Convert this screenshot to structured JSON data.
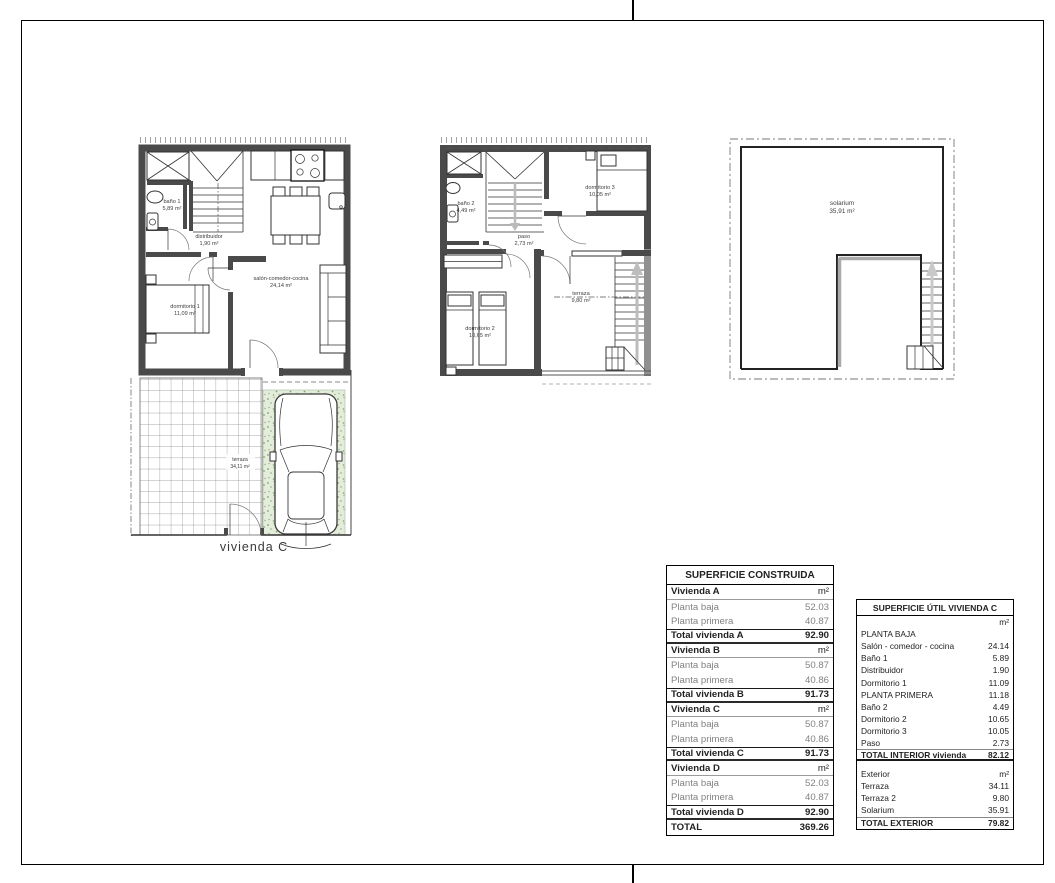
{
  "caption": {
    "vivienda": "vivienda C"
  },
  "plans": {
    "planta_baja": {
      "bano1_name": "baño 1",
      "bano1_area": "5,89 m²",
      "distribuidor_name": "distribuidor",
      "distribuidor_area": "1,90 m²",
      "dormitorio1_name": "dormitorio 1",
      "dormitorio1_area": "11,09 m²",
      "salon_name": "salón-comedor-cocina",
      "salon_area": "24,14 m²"
    },
    "planta_primera": {
      "bano2_name": "baño 2",
      "bano2_area": "4,49 m²",
      "dormitorio3_name": "dormitorio 3",
      "dormitorio3_area": "10,05 m²",
      "paso_name": "paso",
      "paso_area": "2,73 m²",
      "dormitorio2_name": "dormitorio 2",
      "dormitorio2_area": "10,65 m²",
      "terraza_name": "terraza",
      "terraza_area": "9,80 m²"
    },
    "solarium": {
      "name": "solarium",
      "area": "35,91 m²"
    },
    "exterior": {
      "terraza_name": "terraza",
      "terraza_area": "34,11 m²"
    }
  },
  "construida": {
    "title": "SUPERFICIE CONSTRUIDA",
    "rows": [
      {
        "label": "Vivienda A",
        "value": "m²"
      },
      {
        "label": "Planta baja",
        "value": "52.03"
      },
      {
        "label": "Planta primera",
        "value": "40.87"
      },
      {
        "label": "Total vivienda A",
        "value": "92.90"
      },
      {
        "label": "Vivienda B",
        "value": "m²"
      },
      {
        "label": "Planta baja",
        "value": "50.87"
      },
      {
        "label": "Planta primera",
        "value": "40.86"
      },
      {
        "label": "Total vivienda B",
        "value": "91.73"
      },
      {
        "label": "Vivienda C",
        "value": "m²"
      },
      {
        "label": "Planta baja",
        "value": "50.87"
      },
      {
        "label": "Planta primera",
        "value": "40.86"
      },
      {
        "label": "Total vivienda C",
        "value": "91.73"
      },
      {
        "label": "Vivienda D",
        "value": "m²"
      },
      {
        "label": "Planta baja",
        "value": "52.03"
      },
      {
        "label": "Planta primera",
        "value": "40.87"
      },
      {
        "label": "Total vivienda D",
        "value": "92.90"
      },
      {
        "label": "TOTAL",
        "value": "369.26"
      }
    ]
  },
  "util": {
    "title": "SUPERFICIE ÚTIL VIVIENDA C",
    "rows": [
      {
        "label": "",
        "value": "m²"
      },
      {
        "label": "PLANTA BAJA",
        "value": ""
      },
      {
        "label": "Salón - comedor - cocina",
        "value": "24.14"
      },
      {
        "label": "Baño 1",
        "value": "5.89"
      },
      {
        "label": "Distribuidor",
        "value": "1.90"
      },
      {
        "label": "Dormitorio 1",
        "value": "11.09"
      },
      {
        "label": "PLANTA PRIMERA",
        "value": "11.18"
      },
      {
        "label": "Baño 2",
        "value": "4.49"
      },
      {
        "label": "Dormitorio 2",
        "value": "10.65"
      },
      {
        "label": "Dormitorio 3",
        "value": "10.05"
      },
      {
        "label": "Paso",
        "value": "2.73"
      },
      {
        "label": "TOTAL INTERIOR vivienda",
        "value": "82.12"
      },
      {
        "label": "Exterior",
        "value": "m²"
      },
      {
        "label": "Terraza",
        "value": "34.11"
      },
      {
        "label": "Terraza 2",
        "value": "9.80"
      },
      {
        "label": "Solarium",
        "value": "35.91"
      },
      {
        "label": "TOTAL EXTERIOR",
        "value": "79.82"
      }
    ]
  }
}
